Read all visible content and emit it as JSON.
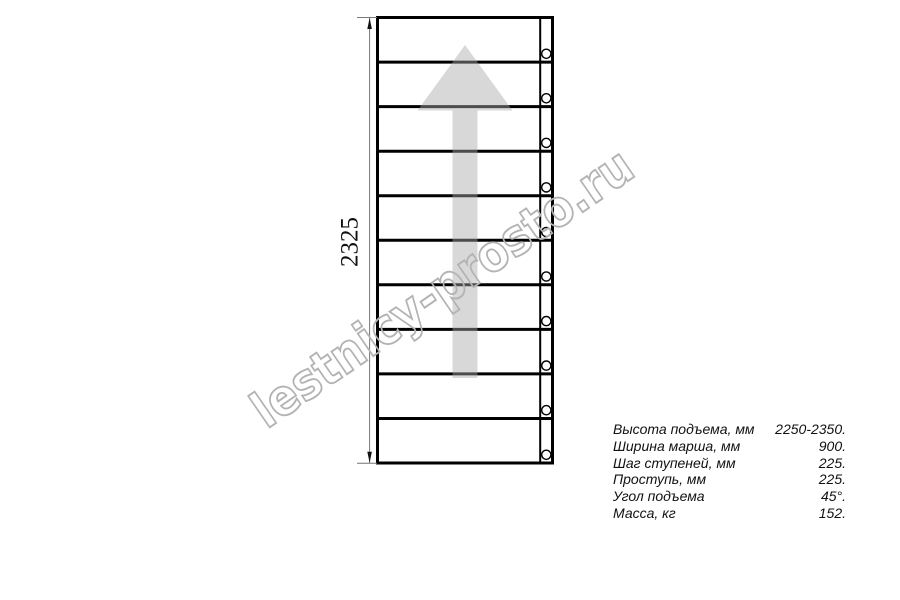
{
  "drawing": {
    "title": "staircase plan view",
    "steps_count": 10,
    "dimension_label": "2325",
    "line_color": "#000000",
    "arrow_color": "#d9d9d9"
  },
  "watermark": {
    "text": "lestnicy-prosto.ru",
    "color": "#b3b3b3"
  },
  "specs": {
    "rows": [
      {
        "label": "Высота подъема, мм",
        "value": "2250-2350."
      },
      {
        "label": "Ширина марша, мм",
        "value": "900."
      },
      {
        "label": "Шаг ступеней, мм",
        "value": "225."
      },
      {
        "label": "Проступь, мм",
        "value": "225."
      },
      {
        "label": "Угол подъема",
        "value": "45°."
      },
      {
        "label": "Масса, кг",
        "value": "152."
      }
    ]
  }
}
